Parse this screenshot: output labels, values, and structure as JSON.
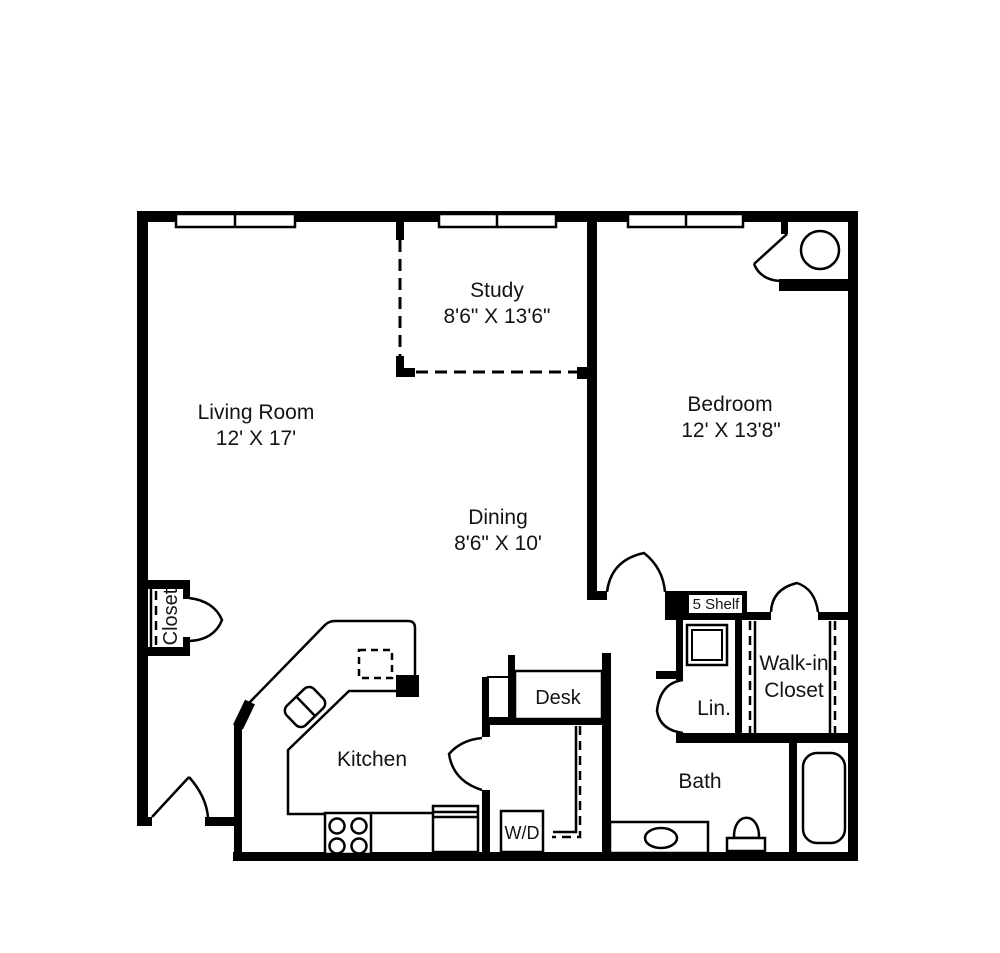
{
  "colors": {
    "wall": "#000000",
    "background": "#ffffff",
    "text": "#141414"
  },
  "rooms": {
    "living_room": {
      "name": "Living Room",
      "dims": "12' X 17'"
    },
    "study": {
      "name": "Study",
      "dims": "8'6\" X 13'6\""
    },
    "dining": {
      "name": "Dining",
      "dims": "8'6\" X 10'"
    },
    "bedroom": {
      "name": "Bedroom",
      "dims": "12' X 13'8\""
    },
    "kitchen": {
      "name": "Kitchen"
    },
    "bath": {
      "name": "Bath"
    }
  },
  "closets": {
    "closet": {
      "name": "Closet"
    },
    "walk_in": {
      "line1": "Walk-in",
      "line2": "Closet"
    },
    "linen": {
      "name": "Lin."
    },
    "shelf": {
      "name": "5 Shelf"
    }
  },
  "fixtures": {
    "desk": {
      "name": "Desk"
    },
    "washer_dryer": {
      "name": "W/D"
    }
  }
}
